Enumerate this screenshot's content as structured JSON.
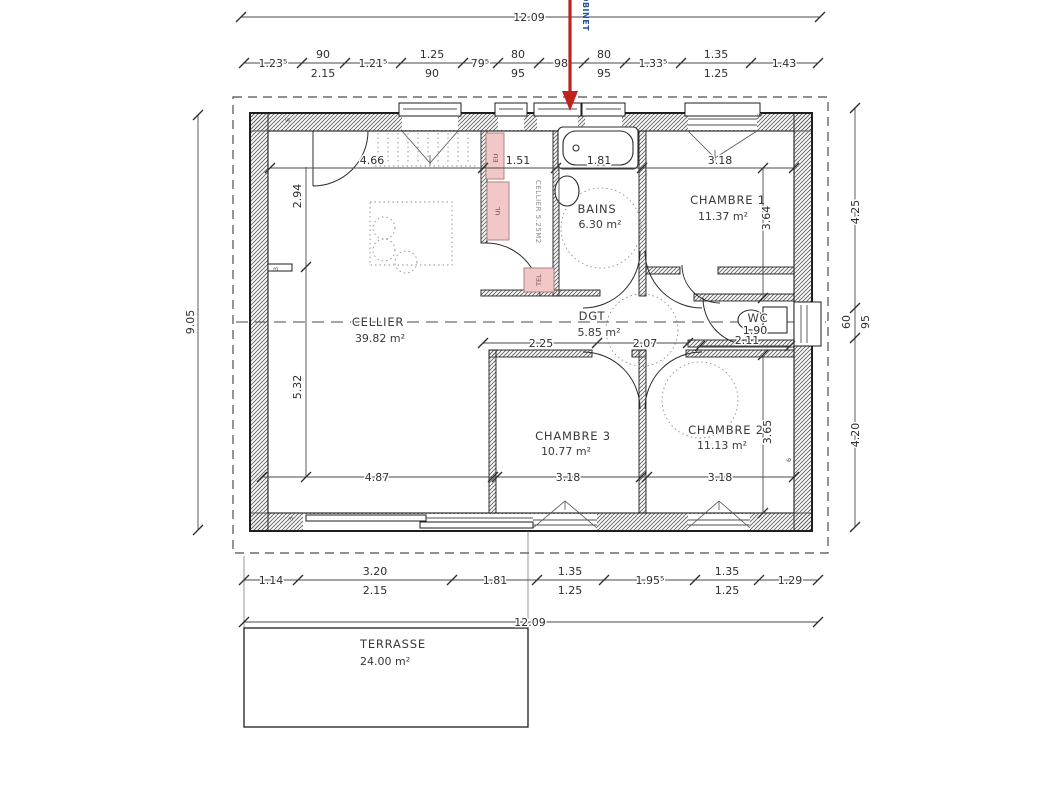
{
  "pointer": {
    "label": "ROBINET",
    "arrow_color": "#c0231c",
    "label_color": "#20509f"
  },
  "dims": {
    "top_overall": "12.09",
    "bottom_overall": "12.09",
    "left_overall": "9.05",
    "top_chain": {
      "s1": "1.23⁵",
      "p2a": "90",
      "p2b": "2.15",
      "s3": "1.21⁵",
      "p4a": "1.25",
      "p4b": "90",
      "s5": "79⁵",
      "p6a": "80",
      "p6b": "95",
      "s7": "98",
      "p8a": "80",
      "p8b": "95",
      "s9": "1.33⁵",
      "p10a": "1.35",
      "p10b": "1.25",
      "s11": "1.43"
    },
    "bottom_chain": {
      "s1": "1.14",
      "p2a": "3.20",
      "p2b": "2.15",
      "s3": "1.81",
      "p4a": "1.35",
      "p4b": "1.25",
      "s5": "1.95⁵",
      "p6a": "1.35",
      "p6b": "1.25",
      "s7": "1.29"
    },
    "right_chain": {
      "s1": "4.25",
      "p2a": "60",
      "p2b": "95",
      "s3": "4.20"
    },
    "interior": {
      "w466": "4.66",
      "w151": "1.51",
      "w181": "1.81",
      "w318top": "3.18",
      "h294": "2.94",
      "h532": "5.32",
      "h364": "3.64",
      "h365": "3.65",
      "w225": "2.25",
      "w207": "2.07",
      "w487": "4.87",
      "w318c3": "3.18",
      "w318c2": "3.18",
      "wc190": "1.90",
      "wc211": "2.11"
    }
  },
  "rooms": {
    "cellier": {
      "name": "CELLIER",
      "area": "39.82 m²"
    },
    "dgt": {
      "name": "DGT",
      "area": "5.85 m²"
    },
    "bains": {
      "name": "BAINS",
      "area": "6.30 m²"
    },
    "chambre1": {
      "name": "CHAMBRE 1",
      "area": "11.37 m²"
    },
    "chambre2": {
      "name": "CHAMBRE 2",
      "area": "11.13 m²"
    },
    "chambre3": {
      "name": "CHAMBRE 3",
      "area": "10.77 m²"
    },
    "wc": {
      "name": "WC"
    },
    "terrasse": {
      "name": "TERRASSE",
      "area": "24.00 m²"
    },
    "cellier_small": {
      "label": "CELLIER 5.25M2"
    }
  },
  "fixtures": {
    "eu": "EU",
    "ul": "UL",
    "tel": "TEL"
  },
  "wall_tags": [
    "6",
    "3",
    "6",
    "3",
    "6"
  ]
}
